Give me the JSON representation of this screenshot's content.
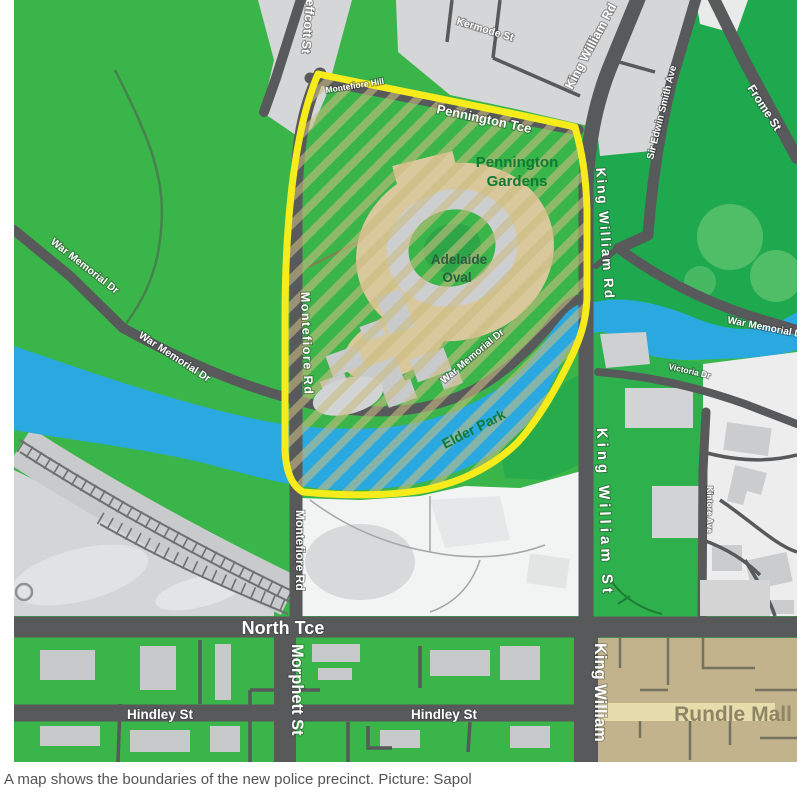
{
  "caption": "A map shows the boundaries of the new police precinct. Picture: Sapol",
  "map": {
    "streets": {
      "jeffcott": "Jeffcott St",
      "kermode": "Kermode St",
      "king_william_rd_top": "King William Rd",
      "king_william_rd_side": "King William Rd",
      "sir_edwin_smith": "Sir Edwin Smith Ave",
      "frome": "Frome St",
      "montefiore_hill": "Montefiore Hill",
      "pennington_tce": "Pennington Tce",
      "war_memorial_1": "War Memorial Dr",
      "war_memorial_2": "War Memorial Dr",
      "war_memorial_inside": "War Memorial Dr",
      "war_memorial_right": "War Memorial Dr",
      "montefiore_rd_upper": "Montefiore Rd",
      "montefiore_rd_lower": "Montefiore Rd",
      "king_william_st": "King William St",
      "victoria_dr": "Victoria Dr",
      "kintore_ave": "Kintore Ave",
      "north_tce": "North Tce",
      "morphett_st": "Morphett St",
      "king_william_bottom": "King William",
      "hindley_1": "Hindley St",
      "hindley_2": "Hindley St"
    },
    "places": {
      "pennington_gardens_1": "Pennington",
      "pennington_gardens_2": "Gardens",
      "adelaide_oval_1": "Adelaide",
      "adelaide_oval_2": "Oval",
      "elder_park": "Elder Park",
      "rundle_mall": "Rundle Mall"
    },
    "colors": {
      "parkland_green": "#3ab54a",
      "deep_green": "#1fa94e",
      "river_blue": "#2aa9e0",
      "road_dark": "#58595b",
      "city_gray": "#d6d7d8",
      "precinct_boundary_yellow": "#f7ec1b",
      "hatch_tan": "#c9bc80",
      "oval_beige": "#d9c89c",
      "rundle_tan": "#c2b38c"
    }
  }
}
